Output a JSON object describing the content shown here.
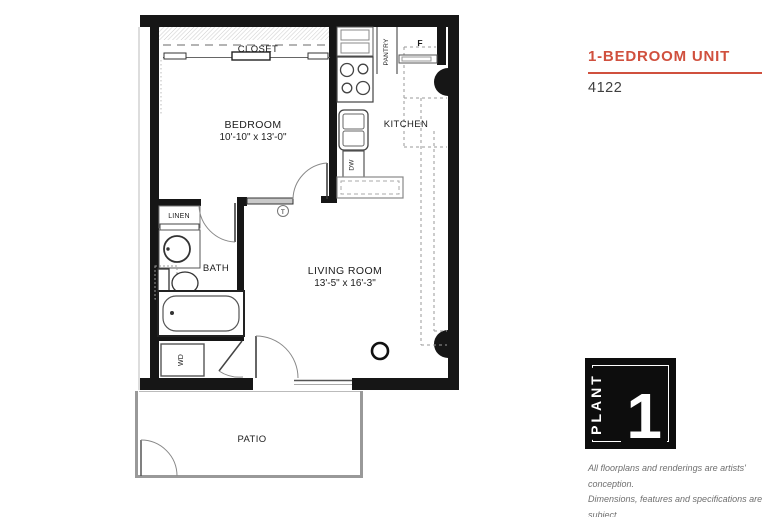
{
  "panel": {
    "title": "1-BEDROOM UNIT",
    "unit_number": "4122",
    "accent_color": "#d0503e",
    "logo": {
      "text": "PLANT",
      "numeral": "1"
    },
    "disclaimer_lines": [
      "All floorplans and renderings are artists' conception.",
      "Dimensions, features and specifications are subject",
      "to change at the discretion of the builder."
    ]
  },
  "floorplan": {
    "bedroom": {
      "name": "BEDROOM",
      "dims": "10'-10\" x 13'-0\""
    },
    "living_room": {
      "name": "LIVING ROOM",
      "dims": "13'-5\" x 16'-3\""
    },
    "kitchen": {
      "name": "KITCHEN"
    },
    "bath": {
      "name": "BATH"
    },
    "patio": {
      "name": "PATIO"
    },
    "closet": {
      "name": "CLOSET"
    },
    "pantry": {
      "name": "PANTRY"
    },
    "linen": {
      "name": "LINEN"
    },
    "labels": {
      "fridge": "F",
      "dishwasher": "DW",
      "washer_dryer": "WD",
      "thermostat": "T"
    }
  }
}
